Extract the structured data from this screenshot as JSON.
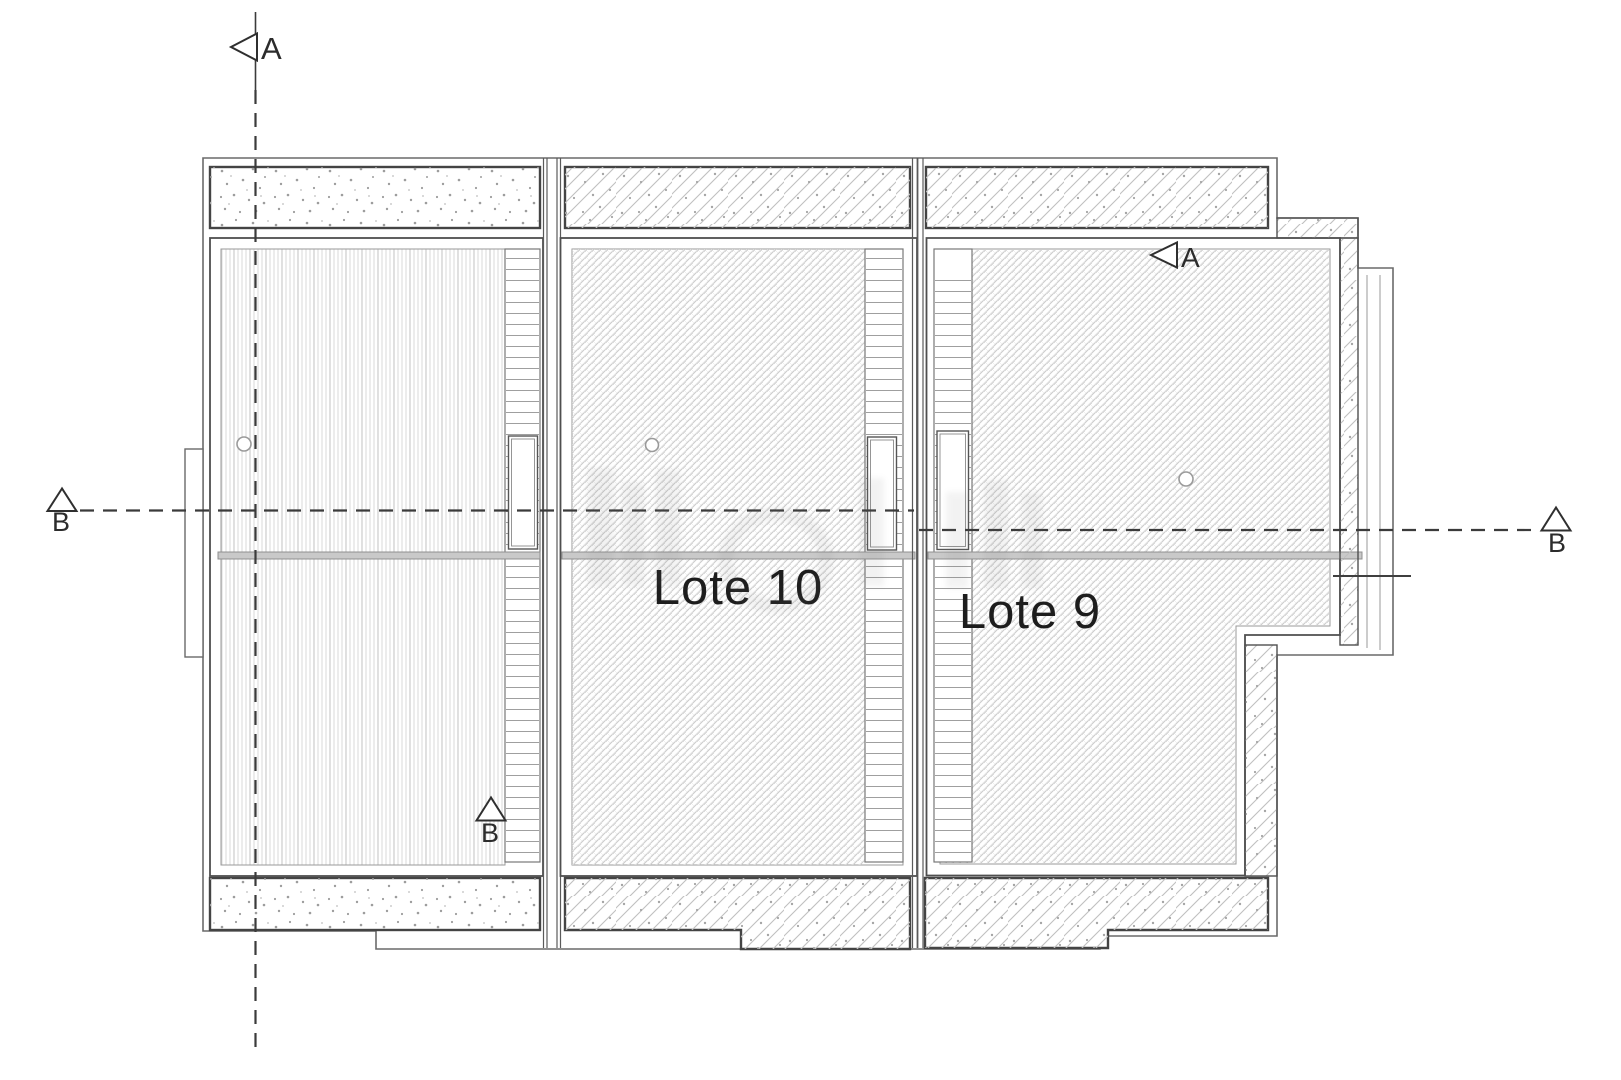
{
  "drawing": {
    "type": "architectural-floor-plan",
    "lot_labels": {
      "lote10": "Lote 10",
      "lote9": "Lote 9"
    },
    "section_markers": {
      "a": "A",
      "b": "B"
    },
    "colors": {
      "background": "#ffffff",
      "line_dark": "#3b3b3b",
      "line_wall": "#4f4f4f",
      "line_outer": "#6a6a6a",
      "hatch_light": "#c6c6c6",
      "stipple_dot": "#9d9d9d",
      "band_fill": "#c9c9c9",
      "label_text": "#1d1d1d"
    }
  }
}
